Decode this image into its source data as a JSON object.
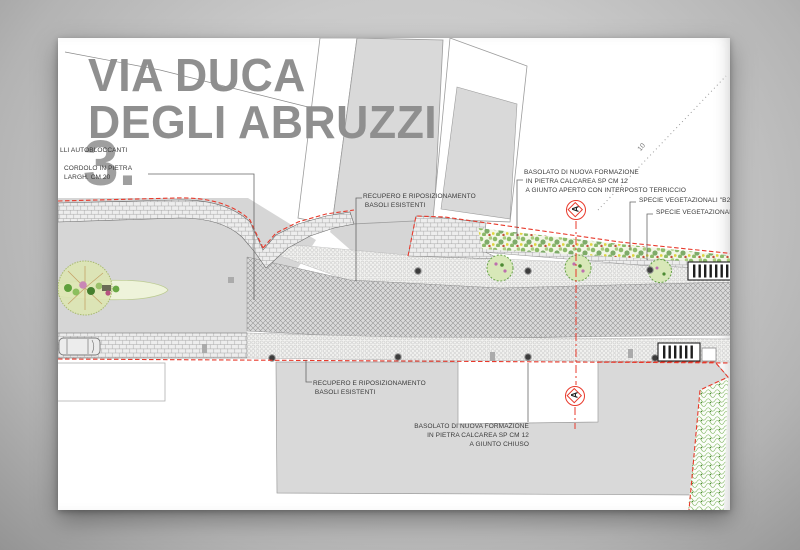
{
  "titleblock": {
    "line1": "VIA DUCA",
    "line2": "DEGLI ABRUZZI",
    "sheet_number": "3."
  },
  "labels": {
    "autobloccanti": "LLI AUTOBLOCCANTI",
    "cordolo": "CORDOLO IN PIETRA\nLARGH. CM 20",
    "recupero_top": "RECUPERO E RIPOSIZIONAMENTO\n BASOLI ESISTENTI",
    "basolato_aperto": "BASOLATO DI NUOVA FORMAZIONE\n IN PIETRA CALCAREA SP CM 12\n A GIUNTO APERTO CON INTERPOSTO TERRICCIO",
    "specie_b2": "SPECIE VEGETAZIONALI \"B2\"",
    "specie_b1": "SPECIE VEGETAZIONALI \"B1",
    "recupero_bottom": "RECUPERO E RIPOSIZIONAMENTO\n BASOLI ESISTENTI",
    "basolato_chiuso": "BASOLATO DI NUOVA FORMAZIONE\nIN PIETRA CALCAREA SP CM 12\nA GIUNTO CHIUSO",
    "distance_marker": "10"
  },
  "section_markers": {
    "top": "A",
    "bottom": "A"
  },
  "colors": {
    "paper": "#ffffff",
    "desk_gray": "#b5b5b5",
    "title_gray": "#8f8f8f",
    "annotation_text": "#3a3a3a",
    "section_red": "#e8392b",
    "building_fill": "#d9d9d9",
    "road_fill": "#d6d6d6",
    "vegetation_green": "#6fae4a",
    "island_fill": "#eef3da"
  }
}
